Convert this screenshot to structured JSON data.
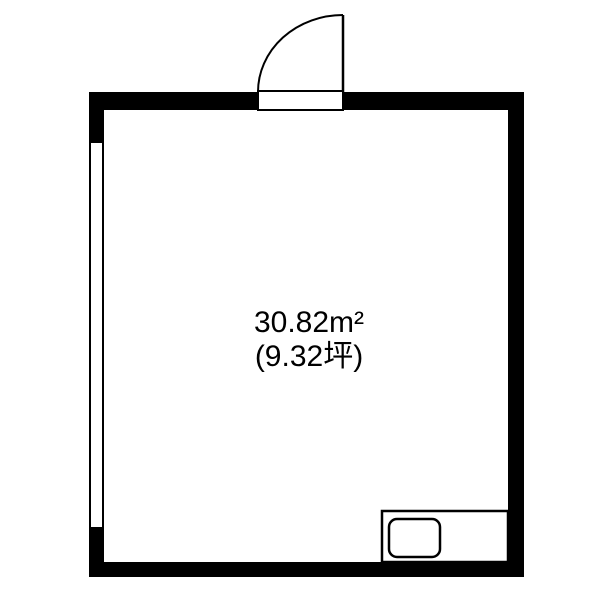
{
  "floorplan": {
    "room": {
      "area_sqm_label": "30.82m²",
      "area_tsubo_label": "(9.32坪)"
    },
    "features": [
      "entry-door-top",
      "window-left-wall",
      "counter-bottom-right",
      "sink-basin"
    ],
    "colors": {
      "wall": "#000000",
      "line": "#000000",
      "background": "#ffffff",
      "floor": "#ffffff"
    }
  }
}
